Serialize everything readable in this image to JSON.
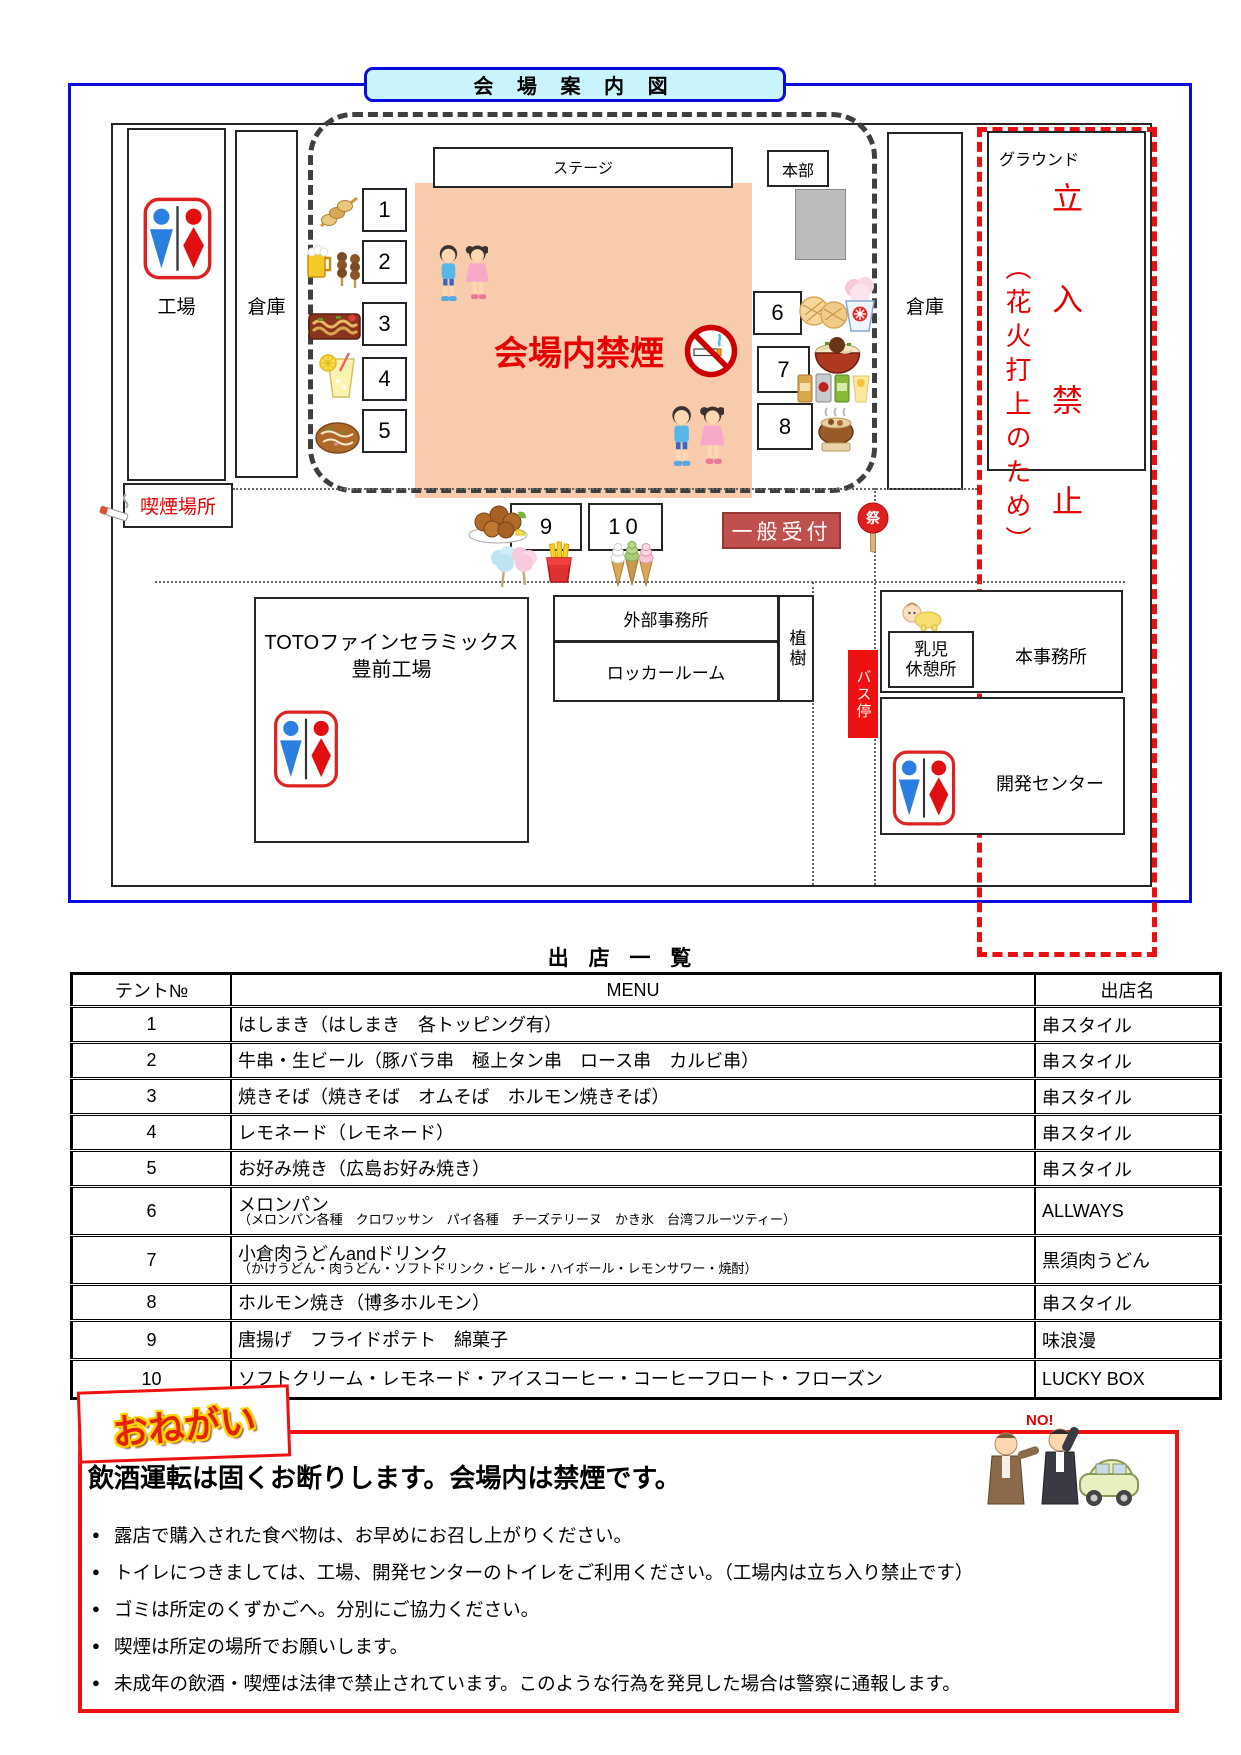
{
  "map": {
    "title": "会 場 案 内 図",
    "stage": "ステージ",
    "hq": "本部",
    "factory": "工場",
    "warehouse_left": "倉庫",
    "warehouse_right": "倉庫",
    "no_smoking_text": "会場内禁煙",
    "smoking_area": "喫煙場所",
    "reception": "一般受付",
    "fan_char": "祭",
    "ground": {
      "label": "グラウンド",
      "keepout": "立入禁止",
      "keepout_reason": "（花火打上のため）"
    },
    "toto": {
      "line1": "TOTOファインセラミックス",
      "line2": "豊前工場"
    },
    "external_office": "外部事務所",
    "locker_room": "ロッカールーム",
    "planting": "植樹",
    "bus_stop": "バス停",
    "nursery": {
      "line1": "乳児",
      "line2": "休憩所"
    },
    "main_office": "本事務所",
    "dev_center": "開発センター",
    "tents": [
      {
        "no": "1"
      },
      {
        "no": "2"
      },
      {
        "no": "3"
      },
      {
        "no": "4"
      },
      {
        "no": "5"
      },
      {
        "no": "6"
      },
      {
        "no": "7"
      },
      {
        "no": "8"
      },
      {
        "no": "9"
      },
      {
        "no": "10"
      }
    ]
  },
  "vendors": {
    "title": "出 店 一 覧",
    "headers": {
      "tent_no": "テント№",
      "menu": "MENU",
      "shop": "出店名"
    },
    "rows": [
      {
        "no": "1",
        "menu": "はしまき（はしまき　各トッピング有）",
        "shop": "串スタイル"
      },
      {
        "no": "2",
        "menu": "牛串・生ビール（豚バラ串　極上タン串　ロース串　カルビ串）",
        "shop": "串スタイル"
      },
      {
        "no": "3",
        "menu": "焼きそば（焼きそば　オムそば　ホルモン焼きそば）",
        "shop": "串スタイル"
      },
      {
        "no": "4",
        "menu": "レモネード（レモネード）",
        "shop": "串スタイル"
      },
      {
        "no": "5",
        "menu": "お好み焼き（広島お好み焼き）",
        "shop": "串スタイル"
      },
      {
        "no": "6",
        "menu": "メロンパン",
        "menu_sub": "（メロンパン各種　クロワッサン　パイ各種　チーズテリーヌ　かき氷　台湾フルーツティー）",
        "shop": "ALLWAYS"
      },
      {
        "no": "7",
        "menu": "小倉肉うどんandドリンク",
        "menu_sub": "（かけうどん・肉うどん・ソフトドリンク・ビール・ハイボール・レモンサワー・焼酎）",
        "shop": "黒須肉うどん"
      },
      {
        "no": "8",
        "menu": "ホルモン焼き（博多ホルモン）",
        "shop": "串スタイル"
      },
      {
        "no": "9",
        "menu": "唐揚げ　フライドポテト　綿菓子",
        "shop": "味浪漫"
      },
      {
        "no": "10",
        "menu": "ソフトクリーム・レモネード・アイスコーヒー・コーヒーフロート・フローズン",
        "shop": "LUCKY BOX"
      }
    ]
  },
  "notice": {
    "label": "おねがい",
    "heading": "飲酒運転は固くお断りします。会場内は禁煙です。",
    "no_text": "NO!",
    "bullets": [
      "露店で購入された食べ物は、お早めにお召し上がりください。",
      "トイレにつきましては、工場、開発センターのトイレをご利用ください。（工場内は立ち入り禁止です）",
      "ゴミは所定のくずかごへ。分別にご協力ください。",
      "喫煙は所定の場所でお願いします。",
      "未成年の飲酒・喫煙は法律で禁止されています。このような行為を発見した場合は警察に通報します。"
    ]
  },
  "colors": {
    "frame_blue": "#0b0be0",
    "title_bg": "#c9f4fb",
    "stage_area_peach": "#f8cbad",
    "alert_red": "#e60000",
    "reception_bg": "#c0504d",
    "hq_gray": "#bcbcbc",
    "bus_stop_bg": "#ee1111"
  },
  "icons": [
    "toilet-icon",
    "no-smoking-icon",
    "cigarette-icon",
    "kids-icon",
    "baby-icon",
    "festival-fan-icon",
    "skewer-icon",
    "beer-yakitori-icon",
    "yakisoba-icon",
    "lemonade-icon",
    "okonomiyaki-icon",
    "melonpan-icon",
    "shaved-ice-icon",
    "udon-icon",
    "drinks-icon",
    "hotpot-icon",
    "karaage-icon",
    "cotton-candy-icon",
    "fries-icon",
    "softcream-icon",
    "no-drink-drive-icon"
  ]
}
